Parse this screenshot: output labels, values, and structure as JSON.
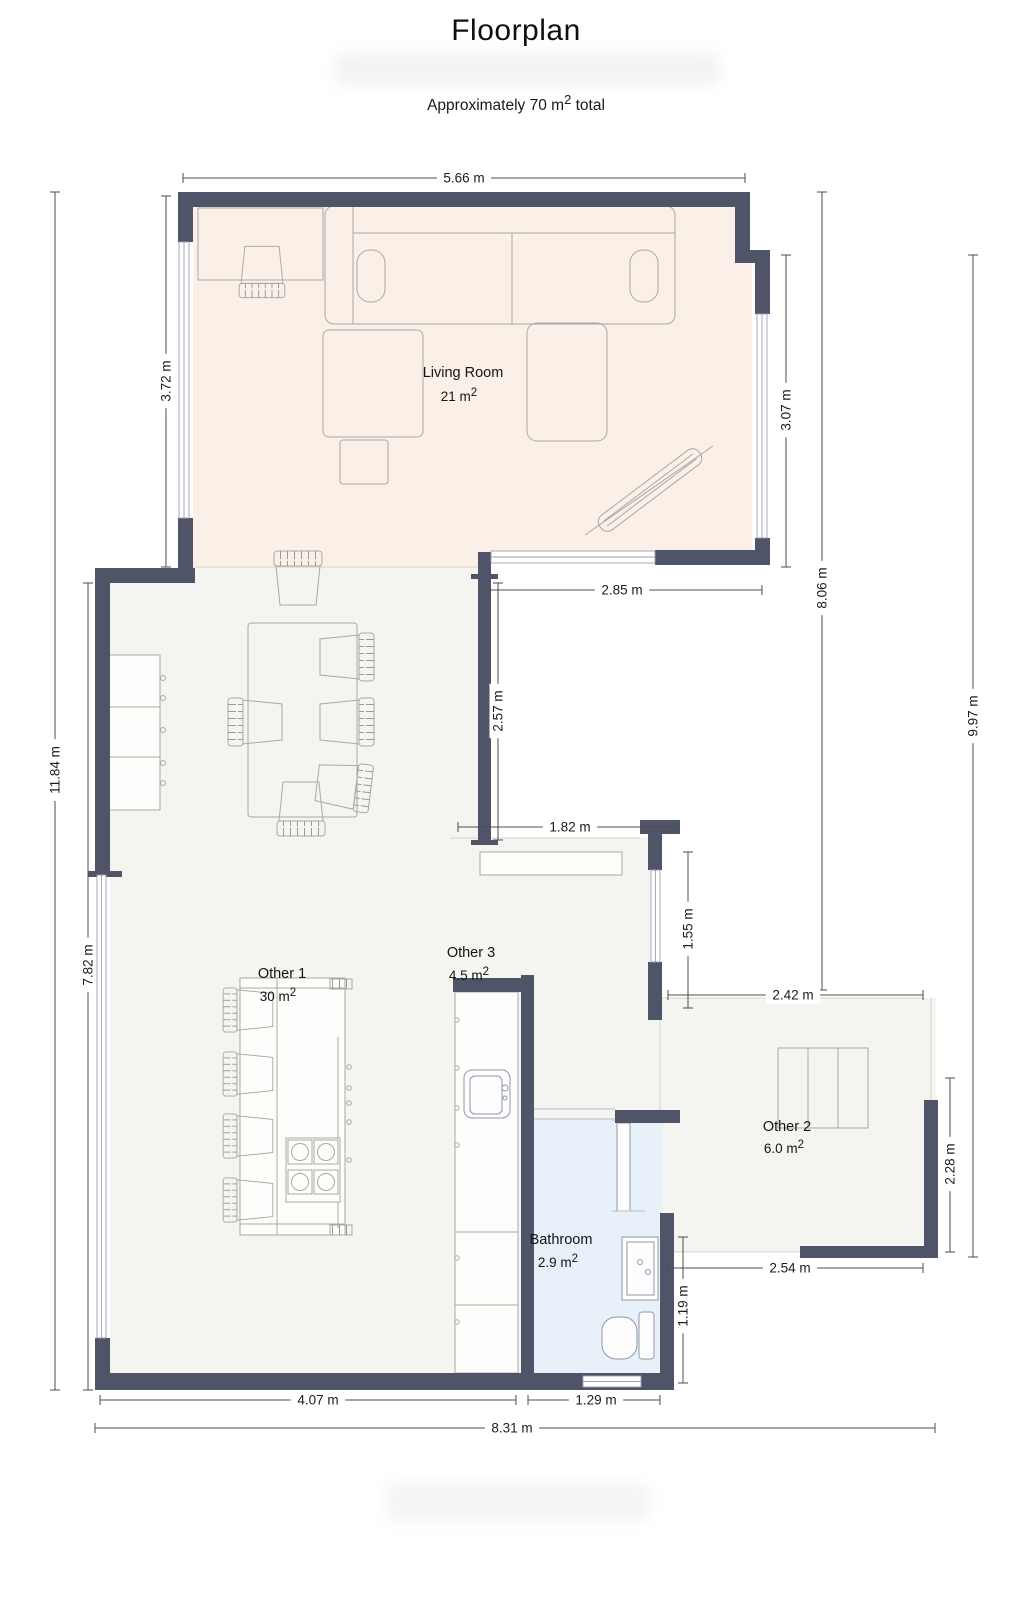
{
  "title": "Floorplan",
  "subtitle": {
    "prefix": "Approximately 70 m",
    "sup": "2",
    "suffix": " total"
  },
  "rooms": {
    "living_room": {
      "name": "Living Room",
      "area": "21 m",
      "area_sup": "2"
    },
    "other_1": {
      "name": "Other 1",
      "area": "30 m",
      "area_sup": "2"
    },
    "other_3": {
      "name": "Other 3",
      "area": "4.5 m",
      "area_sup": "2"
    },
    "other_2": {
      "name": "Other 2",
      "area": "6.0 m",
      "area_sup": "2"
    },
    "bathroom": {
      "name": "Bathroom",
      "area": "2.9 m",
      "area_sup": "2"
    }
  },
  "dimensions": {
    "top_width": "5.66 m",
    "living_left": "3.72 m",
    "living_right": "3.07 m",
    "living_bottom": "2.85 m",
    "right_inner": "8.06 m",
    "right_outer": "9.97 m",
    "left_outer": "11.84 m",
    "left_inner": "7.82 m",
    "notch_height": "2.57 m",
    "other3_top": "1.82 m",
    "other3_right": "1.55 m",
    "other2_top": "2.42 m",
    "other2_right": "2.28 m",
    "other2_bottom": "2.54 m",
    "bathroom_right": "1.19 m",
    "bottom_left": "4.07 m",
    "bottom_bathroom": "1.29 m",
    "bottom_total": "8.31 m"
  },
  "colors": {
    "wall": "#4f5468",
    "living_room_floor": "#faf0e8",
    "floor_gray": "#f4f4f1",
    "bathroom_floor": "#e8f1fa",
    "furniture_line": "#a9a9a3",
    "fixture_line": "#8f98a8",
    "dimension_line": "#4c4c4c",
    "text": "#141414"
  }
}
